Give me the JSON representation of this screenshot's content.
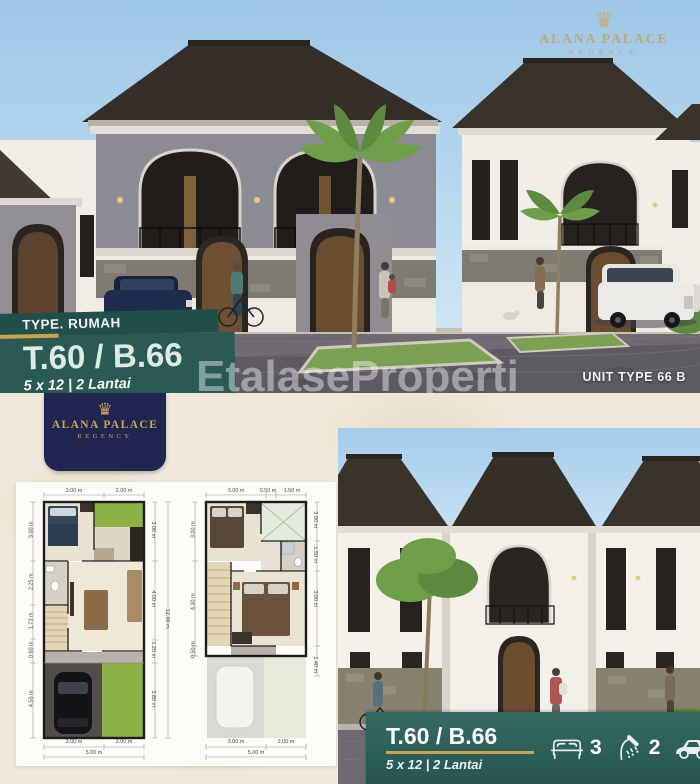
{
  "brand": {
    "name": "ALANA PALACE",
    "subtitle": "REGENCY",
    "crown_icon": "♛"
  },
  "top_overlay": {
    "type_label": "TYPE. RUMAH",
    "title": "T.60 / B.66",
    "dimensions": "5 x 12 | 2 Lantai"
  },
  "unit_label": "UNIT TYPE 66 B",
  "watermark": "EtalaseProperti",
  "bottom_bar": {
    "title": "T.60 / B.66",
    "dimensions": "5 x 12 | 2 Lantai",
    "features": [
      {
        "icon": "bed-icon",
        "value": "3"
      },
      {
        "icon": "shower-icon",
        "value": "2"
      },
      {
        "icon": "car-icon",
        "value": "1"
      }
    ]
  },
  "plans": {
    "ground": {
      "top": [
        "3.00 m",
        "2.00 m"
      ],
      "left": [
        "3.00 m",
        "2.25 m",
        "1.73 m",
        "0.60 m",
        "4.50 m"
      ],
      "right": [
        "3.00 m",
        "4.00 m",
        "1.20 m",
        "3.80 m"
      ],
      "right_total": "12.00 m",
      "bottom": [
        "3.00 m",
        "2.00 m"
      ],
      "bottom_total": "5.00 m"
    },
    "upper": {
      "top": [
        "3.00 m",
        "0.50 m",
        "1.50 m"
      ],
      "left": [
        "3.00 m",
        "4.30 m",
        "0.50 m"
      ],
      "right": [
        "2.00 m",
        "1.50 m",
        "3.00 m",
        "1.40 m"
      ],
      "bottom": [
        "3.00 m",
        "2.00 m"
      ],
      "bottom_total": "5.00 m"
    }
  },
  "colors": {
    "teal": "#2a5a53",
    "gold": "#c9a24b",
    "navy": "#202650",
    "cream": "#f0e9db"
  }
}
